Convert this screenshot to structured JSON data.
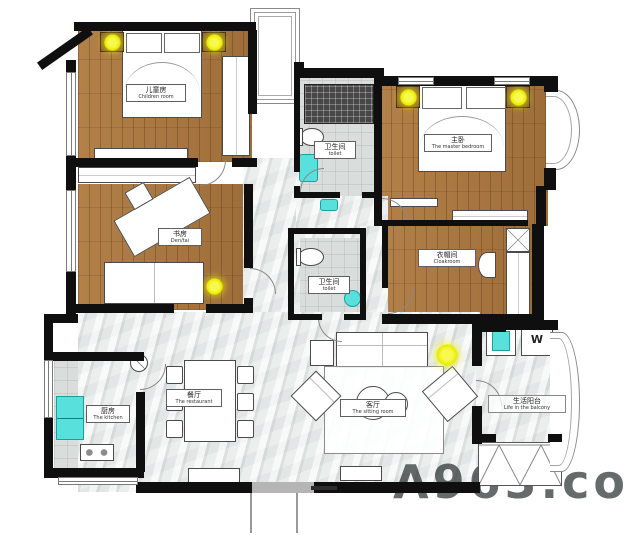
{
  "plan": {
    "rooms": [
      {
        "zh": "儿童房",
        "en": "Children room"
      },
      {
        "zh": "卫生间",
        "en": "toilet"
      },
      {
        "zh": "主卧",
        "en": "The master bedroom"
      },
      {
        "zh": "书房",
        "en": "Den/tai"
      },
      {
        "zh": "衣帽间",
        "en": "Cloakroom"
      },
      {
        "zh": "卫生间",
        "en": "toilet"
      },
      {
        "zh": "厨房",
        "en": "The kitchen"
      },
      {
        "zh": "餐厅",
        "en": "The restaurant"
      },
      {
        "zh": "客厅",
        "en": "The sitting room"
      },
      {
        "zh": "生活阳台",
        "en": "Life in the balcony"
      }
    ],
    "appliances": {
      "washer_label": "W"
    },
    "watermark": "A963.co",
    "colors": {
      "wall": "#0f0f0f",
      "wood": "#ab7a43",
      "marble": "#e6e9e8",
      "tile": "#d8dcdb",
      "fixture_cyan": "#58e0dd",
      "light_yellow": "#eef200"
    }
  }
}
